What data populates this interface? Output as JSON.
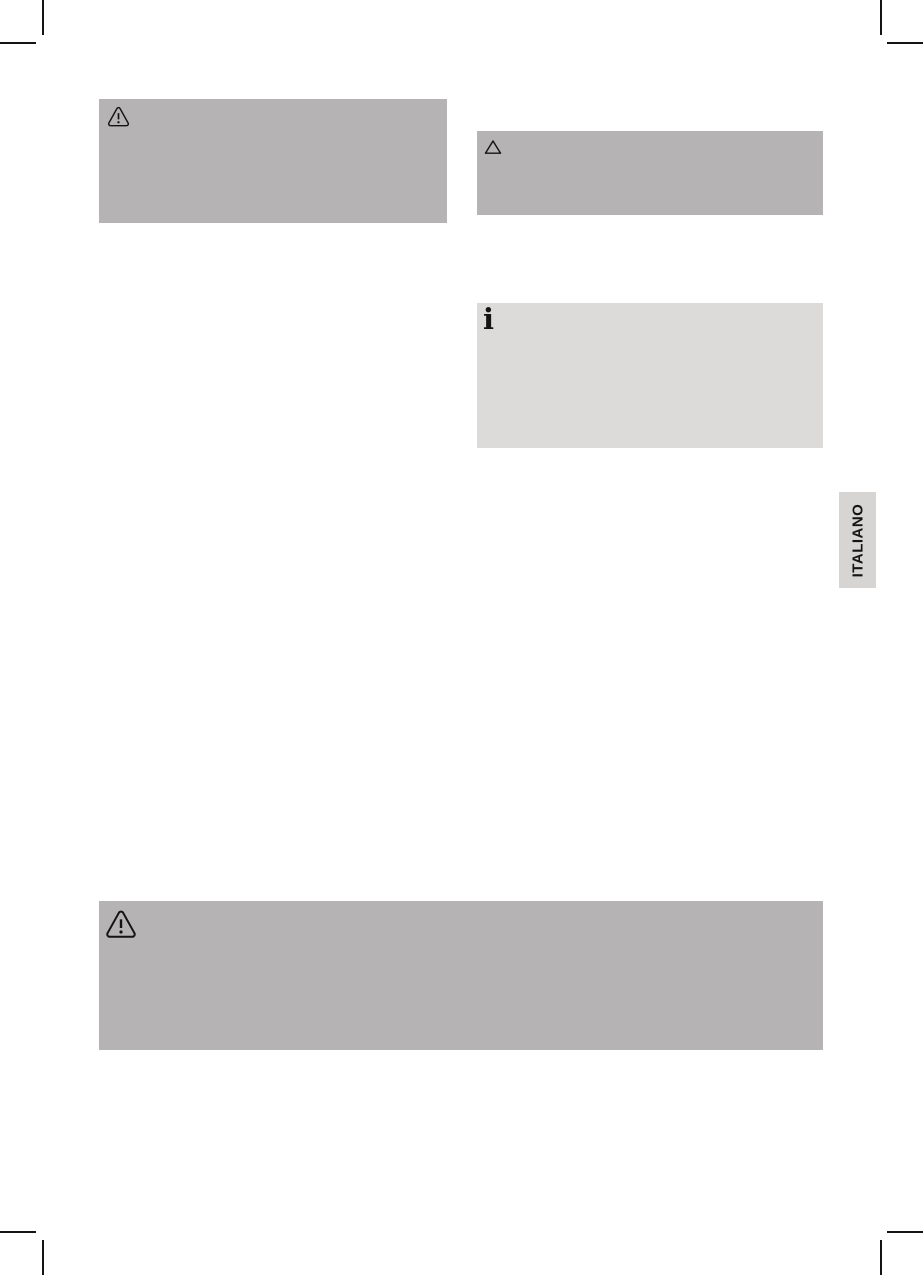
{
  "language_tab": {
    "label": "ITALIANO"
  },
  "notices": {
    "warning_left": {
      "icon": "warning-triangle-icon"
    },
    "caution_right": {
      "icon": "triangle-icon"
    },
    "info_right": {
      "icon": "info-icon",
      "glyph": "i"
    },
    "warning_bottom": {
      "icon": "warning-triangle-icon"
    }
  },
  "colors": {
    "notice_gray": "#b5b3b3",
    "info_gray": "#dcdbd9",
    "tab_gray": "#d6d5d4",
    "mark_color": "#141414",
    "page_background": "#ffffff"
  }
}
